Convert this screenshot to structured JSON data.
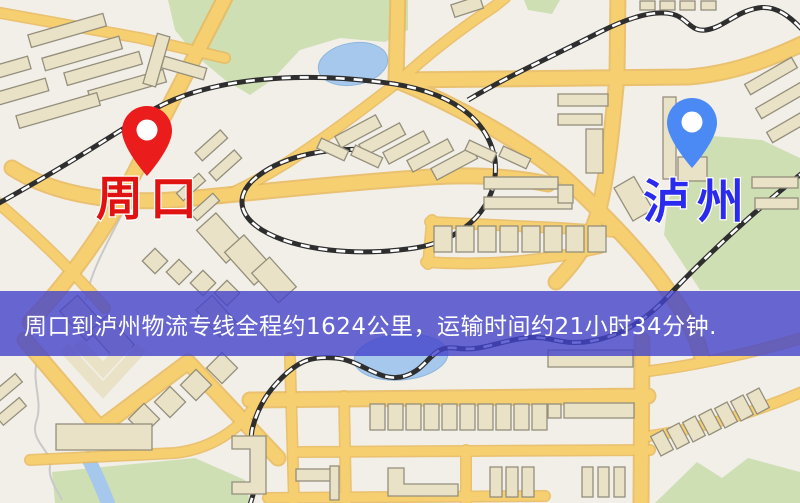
{
  "map": {
    "origin_marker": {
      "label": "周口",
      "label_color": "#e01212",
      "pin_color": "#ea1c1c"
    },
    "destination_marker": {
      "label": "泸州",
      "label_color": "#2b2bef",
      "pin_color": "#4b8af5"
    },
    "banner": {
      "text": "周口到泸州物流专线全程约1624公里，运输时间约21小时34分钟."
    },
    "colors": {
      "background": "#f2efe8",
      "road": "#f6cf70",
      "road_casing": "#e7b95b",
      "building": "#eae2c6",
      "building_outline": "#948f7c",
      "green": "#cfdfb4",
      "water": "#a5c8ec",
      "railway": "#2e2e2e",
      "banner_overlay": "#4343cb",
      "banner_text": "#ffffff"
    }
  }
}
